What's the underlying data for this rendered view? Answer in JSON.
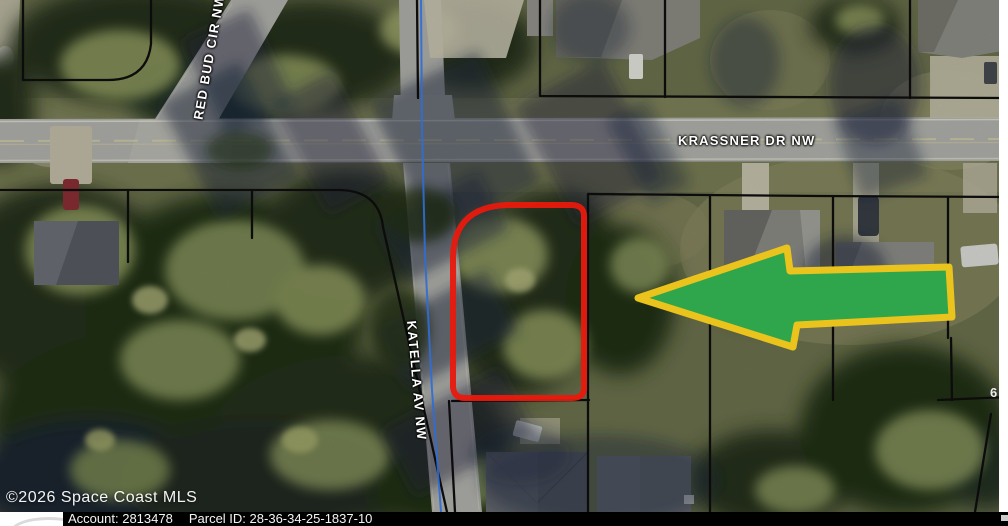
{
  "map": {
    "streets": {
      "krassner": "KRASSNER DR NW",
      "red_bud": "RED BUD CIR NW",
      "katella": "KATELLA AV NW"
    },
    "edge_partial_label": "6",
    "watermark": "©2026 Space Coast MLS",
    "overlay": {
      "parcel_outline_color": "#e8190d",
      "arrow_fill_color": "#2fa64b",
      "arrow_border_color": "#eac41d",
      "gis_line_color": "#2f6cd4",
      "lot_line_color": "#0c0c0c"
    }
  },
  "footer": {
    "account_label": "Account:",
    "account_value": "2813478",
    "parcel_id_label": "Parcel ID:",
    "parcel_id_value": "28-36-34-25-1837-10"
  }
}
